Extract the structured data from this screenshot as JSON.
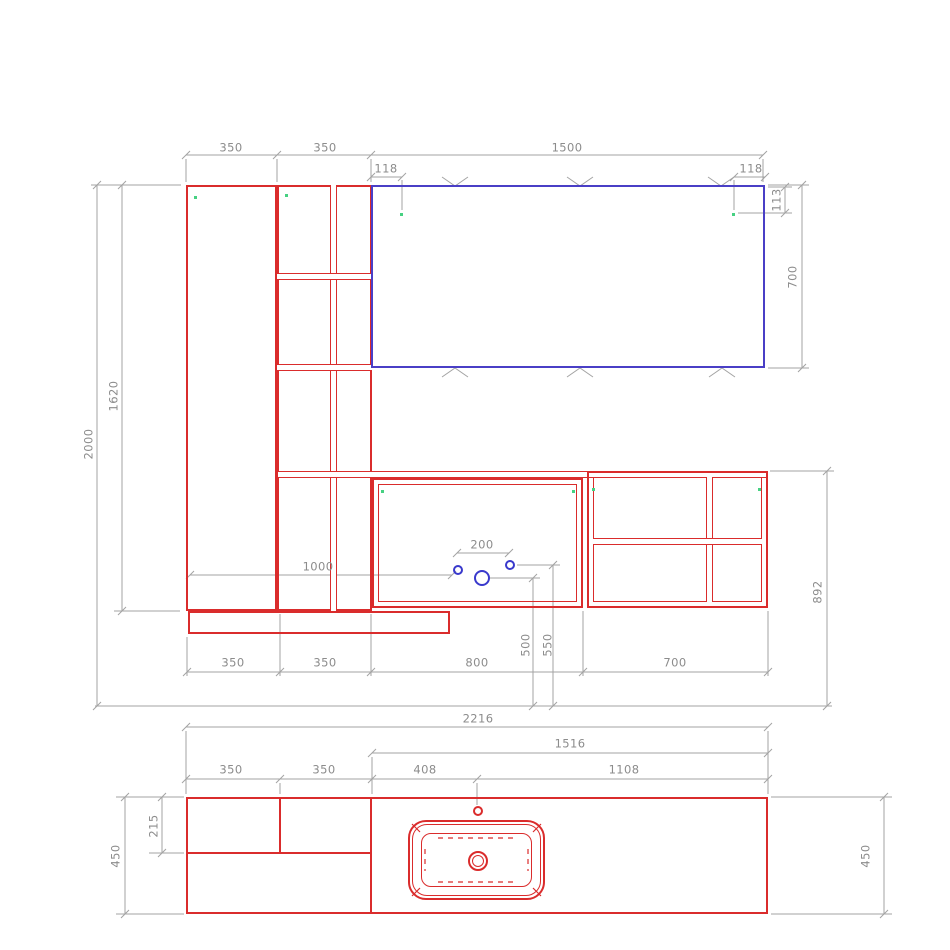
{
  "colors": {
    "furniture": "#da2c2c",
    "mirror": "#4a3fc6",
    "plumbing": "#3939cc",
    "dimension": "#a3a3a3",
    "dimtext": "#8c8c8c",
    "marker": "#46d182"
  },
  "elevation": {
    "dims": {
      "left_unit_w": "350",
      "shelf_unit_w": "350",
      "mirror_w": "1500",
      "mirror_inset_left": "118",
      "mirror_inset_right": "118",
      "marker_inset_top": "113",
      "mirror_h": "700",
      "total_h": "2000",
      "column_h": "1620",
      "plumbing_x": "1000",
      "supply_spacing": "200",
      "drain_h": "500",
      "supply_h": "550",
      "worktop_h": "892",
      "bottom_left_unit_w": "350",
      "bottom_shelf_unit_w": "350",
      "vanity_w": "800",
      "wall_unit_w": "700"
    }
  },
  "plan": {
    "dims": {
      "total_w": "2216",
      "counter_w": "1516",
      "left_unit_w": "350",
      "shelf_unit_w": "350",
      "basin_offset": "408",
      "tap_offset": "1108",
      "shelf_depth": "215",
      "depth_left": "450",
      "depth_right": "450"
    }
  }
}
